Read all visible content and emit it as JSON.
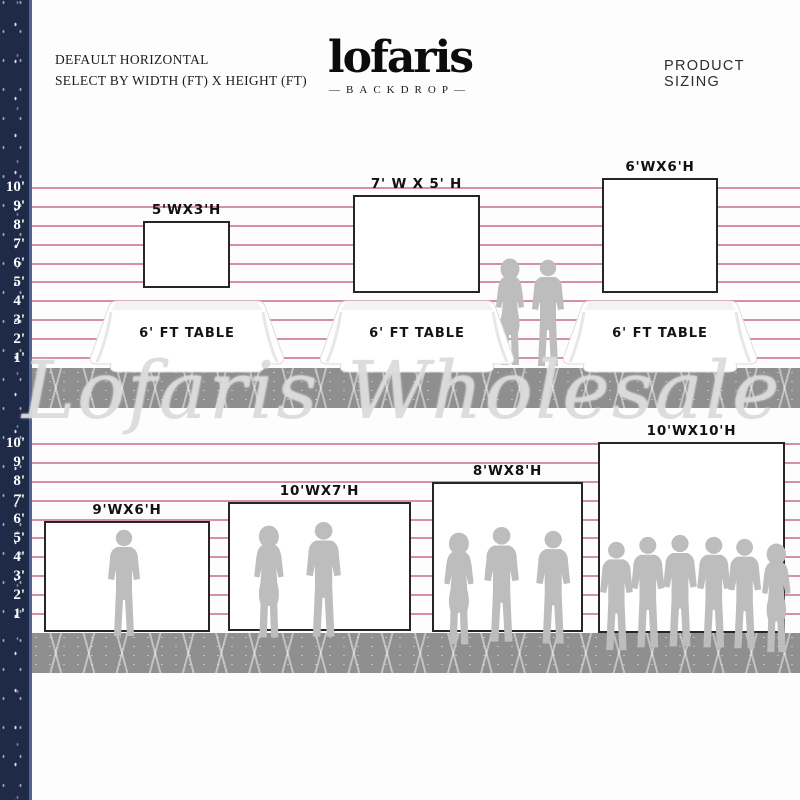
{
  "header": {
    "left_line1": "DEFAULT HORIZONTAL",
    "left_line2": "SELECT BY WIDTH (FT) X HEIGHT (FT)",
    "logo": "lofaris",
    "logo_sub": "—BACKDROP—",
    "right": "PRODUCT SIZING"
  },
  "ruler": {
    "feet": [
      "10'",
      "9'",
      "8'",
      "7'",
      "6'",
      "5'",
      "4'",
      "3'",
      "2'",
      "1'"
    ]
  },
  "backdrops": {
    "b5x3": "5'WX3'H",
    "b7x5": "7' W X 5' H",
    "b6x6": "6'WX6'H",
    "b9x6": "9'WX6'H",
    "b10x7": "10'WX7'H",
    "b8x8": "8'WX8'H",
    "b10x10": "10'WX10'H"
  },
  "tables": {
    "label": "6' FT TABLE"
  },
  "watermark": "Lofaris Wholesale",
  "colors": {
    "navy": "#1e2a47",
    "line_pink": "#ce7d94",
    "floor_gray": "#8f8f8f",
    "silhouette_gray": "#bdbdbd"
  }
}
